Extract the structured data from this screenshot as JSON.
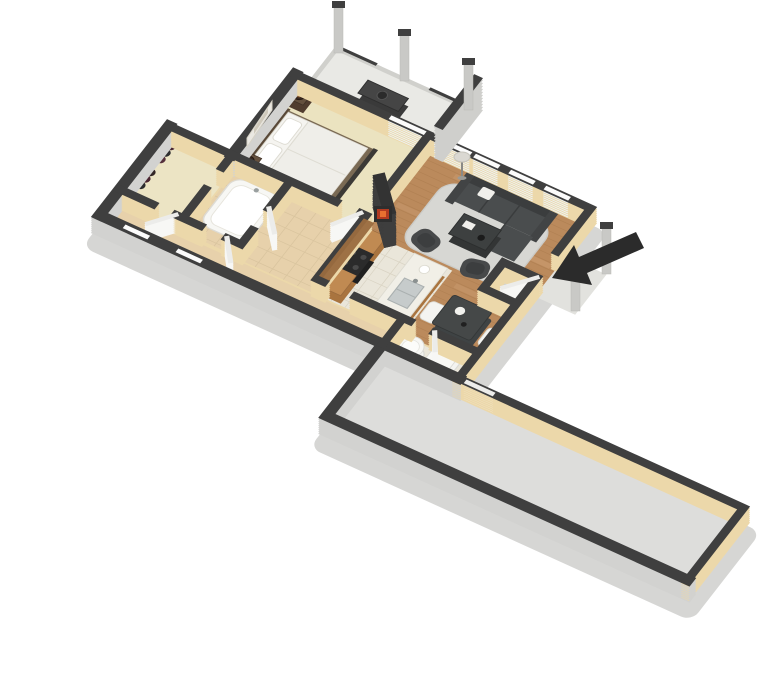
{
  "meta": {
    "description": "3D isometric floor plan rendering of a one-bedroom apartment with balcony, entry arrow and long garage storage wing, floating on a white background",
    "background": "#ffffff",
    "view": "isometric-3d",
    "visible_text": "none"
  },
  "palette": {
    "wall_cap": "#3f3f3f",
    "wall_interior_face": "#ecd8aa",
    "wall_exterior_face": "#d2d2d0",
    "plinth": "#d6d6d4",
    "bedroom_floor": "#ebe3c0",
    "closet_floor": "#ece4c4",
    "bath_tile": "#e7d1ab",
    "kitchen_tile": "#eae6da",
    "wood_floor": "#bb8a5c",
    "balcony_floor": "#e9e9e5",
    "garage_floor": "#dddddb",
    "porch_floor": "#e2e2de",
    "rug": "#d7d7d3",
    "sofa": "#4a4d4e",
    "counter_wood": "#a9743f",
    "counter_top": "#c08a52",
    "island_top": "#f1efe7",
    "entry_arrow": "#2b2b2b",
    "fire_glow": "#b23a20",
    "post_gray": "#c9c9c6"
  },
  "rooms": [
    {
      "id": "bedroom",
      "floor_color": "#ebe3c0"
    },
    {
      "id": "walk-in-closet",
      "floor_color": "#ece4c4"
    },
    {
      "id": "bathroom",
      "floor_color": "#e7d1ab"
    },
    {
      "id": "hallway",
      "floor_color": "#e7d1ab"
    },
    {
      "id": "kitchen",
      "floor_color": "#eae6da"
    },
    {
      "id": "living-room",
      "floor_color": "#bb8a5c"
    },
    {
      "id": "dining-area",
      "floor_color": "#bb8a5c"
    },
    {
      "id": "entry",
      "floor_color": "#bb8a5c"
    },
    {
      "id": "coat-closet",
      "floor_color": "#ece4c4"
    },
    {
      "id": "utility-room",
      "floor_color": "#eae6da"
    },
    {
      "id": "balcony",
      "floor_color": "#e9e9e5"
    },
    {
      "id": "garage-storage",
      "floor_color": "#dddddb"
    },
    {
      "id": "entry-porch",
      "floor_color": "#e2e2de"
    }
  ],
  "structure": {
    "windows": 3,
    "sliding_glass_doors": 2,
    "balcony_posts": 3,
    "porch_posts": 2,
    "tall_privacy_wall": 1,
    "entry_marker": "solid black arrow pointing at open entry door"
  },
  "furniture": [
    "double-bed",
    "nightstand-north",
    "nightstand-south",
    "table-lamp-north",
    "table-lamp-south",
    "wall-art",
    "hanging-clothes",
    "bathtub",
    "kitchen-counter",
    "stove",
    "kitchen-island-with-sink",
    "wall-cabinets",
    "dining-table",
    "dining-chair-west",
    "dining-chair-east",
    "sectional-sofa",
    "sofa-pillow",
    "coffee-table",
    "accent-chair-west",
    "accent-chair-south",
    "area-rug",
    "floor-lamp",
    "fireplace",
    "water-heater",
    "washer",
    "balcony-bench-grill",
    "potted-plant"
  ]
}
